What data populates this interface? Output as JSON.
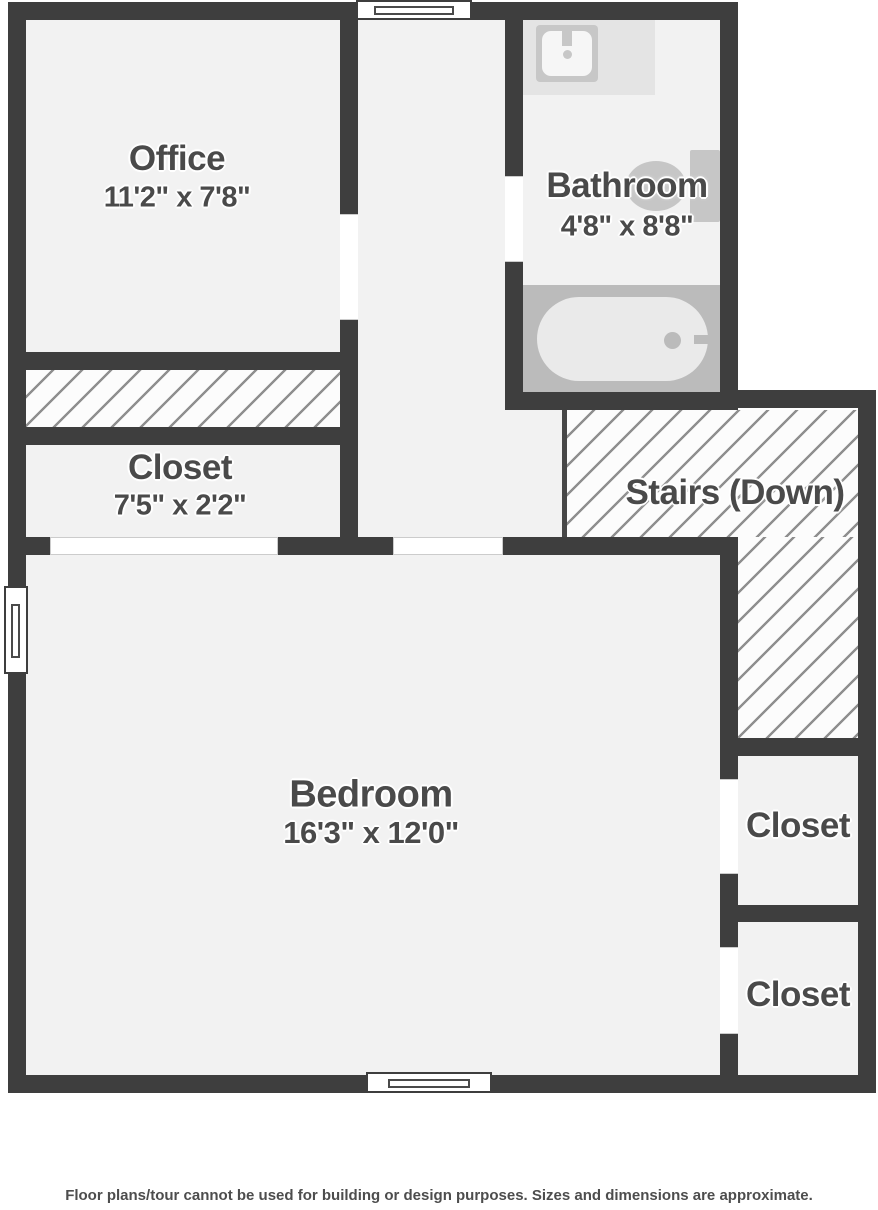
{
  "page": {
    "type": "floor-plan",
    "disclaimer": "Floor plans/tour cannot be used for building or design purposes. Sizes and dimensions are approximate."
  },
  "palette": {
    "wall": "#3e3e3e",
    "floor": "#f2f2f2",
    "label_text": "#4a4a4a",
    "fixture_gray": "#c6c6c6",
    "tub_area_gray": "#bbbbbb",
    "counter_gray": "#e4e4e4",
    "hatch_line": "#8f8f8f",
    "door_gap": "#ffffff"
  },
  "icons": {
    "sink": "sink-icon",
    "toilet": "toilet-icon",
    "bathtub": "bathtub-icon",
    "window": "window-symbol",
    "stairs_hatch": "hatched-area",
    "dead_space_hatch": "hatched-area"
  },
  "rooms": {
    "office": {
      "name": "Office",
      "dims": "11'2\" x 7'8\""
    },
    "bathroom": {
      "name": "Bathroom",
      "dims": "4'8\" x 8'8\""
    },
    "hall_closet": {
      "name": "Closet",
      "dims": "7'5\" x 2'2\""
    },
    "stairs": {
      "name": "Stairs (Down)"
    },
    "bedroom": {
      "name": "Bedroom",
      "dims": "16'3\" x 12'0\""
    },
    "closet_upper": {
      "name": "Closet"
    },
    "closet_lower": {
      "name": "Closet"
    }
  }
}
